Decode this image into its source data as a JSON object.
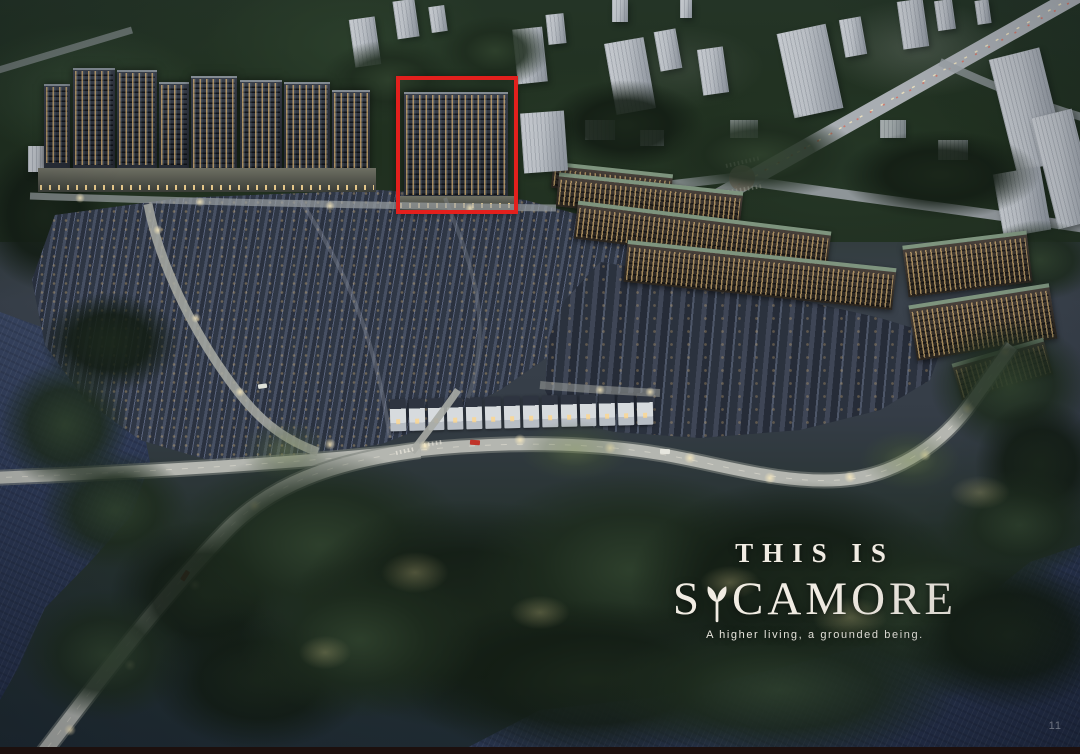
{
  "overlay": {
    "heading": "THIS IS",
    "brand": "SYCAMORE",
    "brand_prefix": "S",
    "brand_suffix": "CAMORE",
    "tagline": "A higher living, a grounded being.",
    "page_number": "11"
  },
  "annotation": {
    "highlight_color": "#e3201d"
  },
  "palette": {
    "highlight_red": "#e3201d",
    "water_deep": "#222c44",
    "water_light": "#3a4763",
    "forest_dark": "#1c2a20",
    "forest_light": "#35492f",
    "road_grey": "#b3b6b0",
    "window_warm": "#eec27c",
    "roof_green": "#7e947e",
    "distant_building": "#b9bec4",
    "facade_dark": "#272c35",
    "text_cream": "#f1ece3",
    "bottom_bar": "#1c100e"
  }
}
